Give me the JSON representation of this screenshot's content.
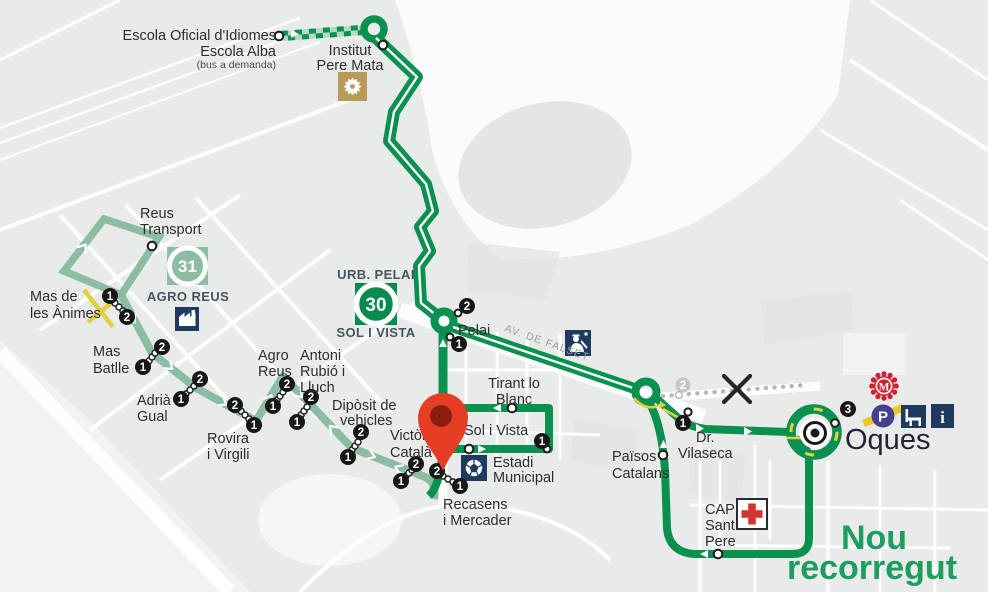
{
  "map": {
    "type": "bus-route-map",
    "colors": {
      "route_30_green": "#0a9150",
      "route_31_sage": "#8cbda3",
      "demand_stripe_light": "#b7d8c6",
      "road_marking_yellow": "#e3cf3d",
      "pin_red": "#e63e25",
      "pin_inner_red": "#8c1d10",
      "poi_navy": "#1e3a5f",
      "health_cross_red": "#d23430",
      "mercat_red": "#cf2030",
      "parking_indigo": "#45408e",
      "new_route_text_green": "#1d9e60",
      "removed_gray": "#b4b6b7"
    },
    "routes": {
      "r30": {
        "number": "30"
      },
      "r31": {
        "number": "31"
      }
    },
    "areas": {
      "urb_pelai": "URB. PELAI",
      "sol_i_vista": "SOL I VISTA",
      "agro_reus": "AGRO REUS"
    },
    "streets": {
      "av_falset": "AV. DE FALSET"
    },
    "numbers": {
      "n1": "1",
      "n2": "2",
      "n3": "3"
    },
    "stops": {
      "escola": {
        "line1": "Escola Oficial d'Idiomes",
        "line2": "Escola Alba",
        "note": "(bus a demanda)"
      },
      "institut": {
        "line1": "Institut",
        "line2": "Pere Mata"
      },
      "reus_transport": {
        "line1": "Reus",
        "line2": "Transport"
      },
      "mas_animes": {
        "line1": "Mas de",
        "line2": "les Ànimes"
      },
      "mas_batlle": {
        "line1": "Mas",
        "line2": "Batlle"
      },
      "adria_gual": {
        "line1": "Adrià",
        "line2": "Gual"
      },
      "rovira": {
        "line1": "Rovira",
        "line2": "i Virgili"
      },
      "agro_reus": {
        "line1": "Agro",
        "line2": "Reus"
      },
      "antoni": {
        "line1": "Antoni",
        "line2": "Rubió i",
        "line3": "Lluch"
      },
      "diposit": {
        "line1": "Dipòsit de",
        "line2": "vehicles"
      },
      "victoria": {
        "line1": "Victòria",
        "line2": "Català"
      },
      "recasens": {
        "line1": "Recasens",
        "line2": "i Mercader"
      },
      "sol_vista": {
        "line1": "Sol i Vista"
      },
      "estadi": {
        "line1": "Estadi",
        "line2": "Municipal"
      },
      "tirant": {
        "line1": "Tirant lo",
        "line2": "Blanc"
      },
      "pelai": {
        "line1": "Pelai"
      },
      "paisos": {
        "line1": "Països",
        "line2": "Catalans"
      },
      "vilaseca": {
        "line1": "Dr.",
        "line2": "Vilaseca"
      },
      "cap_sant_pere": {
        "line1": "CAP",
        "line2": "Sant",
        "line3": "Pere"
      },
      "oques": {
        "line1": "Oques"
      }
    },
    "poi": {
      "mercat": "M",
      "parking": "P",
      "info": "i"
    },
    "annotation": {
      "line1": "Nou",
      "line2": "recorregut"
    }
  }
}
